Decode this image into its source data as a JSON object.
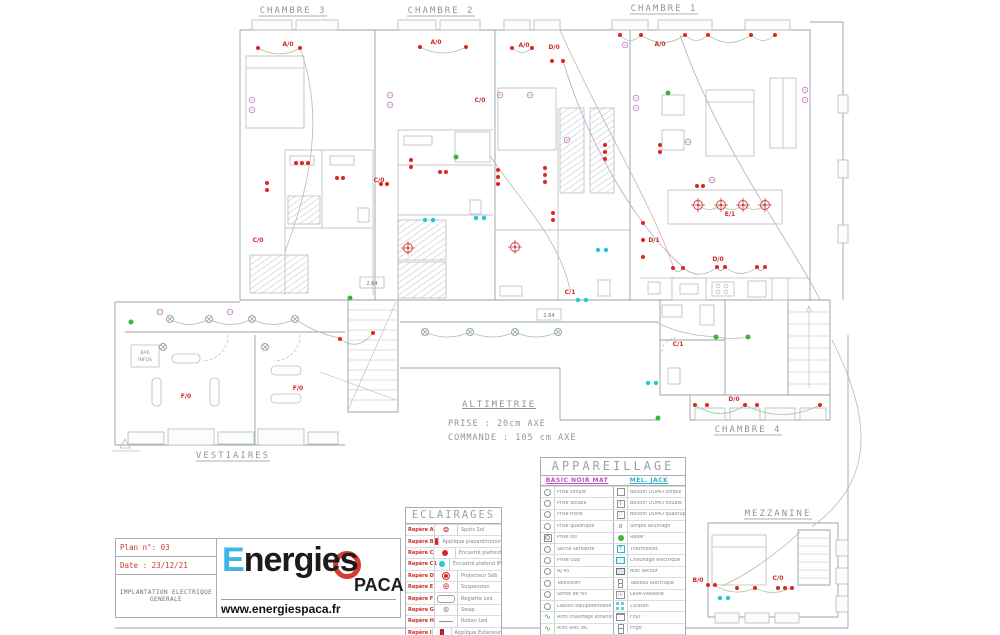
{
  "plan": {
    "room_labels": [
      "CHAMBRE 3",
      "CHAMBRE 2",
      "CHAMBRE 1",
      "VESTIAIRES",
      "CHAMBRE 4",
      "MEZZANINE"
    ],
    "circuit_labels": [
      "A/0",
      "A/0",
      "A/0",
      "D/0",
      "A/0",
      "C/0",
      "C/0",
      "C/0",
      "E/1",
      "D/1",
      "D/0",
      "C/1",
      "C/1",
      "D/0",
      "F/0",
      "F/0",
      "B/0",
      "C/0"
    ],
    "dim_labels": [
      "2.64",
      "2.64"
    ],
    "annex_box_line1": "BAR",
    "annex_box_line2": "INFOS"
  },
  "altimetrie": {
    "title": "ALTIMETRIE",
    "line1": "PRISE : 20cm AXE",
    "line2": "COMMANDE : 105 cm AXE"
  },
  "eclairages": {
    "title": "ECLAIRAGES",
    "rows": [
      {
        "repere": "Repère A",
        "icon": "spots-sol-icon",
        "desc": "Spots Sol"
      },
      {
        "repere": "Repère B",
        "icon": "applique-placard-icon",
        "desc": "Applique placard/miroir"
      },
      {
        "repere": "Repère C",
        "icon": "encastre-plafond-icon",
        "desc": "Encastré plafond"
      },
      {
        "repere": "Repère C1",
        "icon": "encastre-plafond-ip-icon",
        "desc": "Encastré plafond IP"
      },
      {
        "repere": "Repère D",
        "icon": "projecteur-icon",
        "desc": "Projecteur Sdb"
      },
      {
        "repere": "Repère E",
        "icon": "suspension-icon",
        "desc": "Suspension"
      },
      {
        "repere": "Repère F",
        "icon": "reglette-led-icon",
        "desc": "Reglette Led"
      },
      {
        "repere": "Repère G",
        "icon": "swap-icon",
        "desc": "Swap"
      },
      {
        "repere": "Repère H",
        "icon": "ruban-led-icon",
        "desc": "Ruban Led"
      },
      {
        "repere": "Repère I",
        "icon": "applique-exterieur-icon",
        "desc": "Applique Exterieur"
      },
      {
        "repere": "Repère J",
        "icon": "prise-commandee-icon",
        "desc": "Prise commandée"
      }
    ]
  },
  "appareillage": {
    "title": "APPAREILLAGE",
    "left_header": "BASIC NOIR MAT",
    "right_header": "MEL. JACK",
    "rows": [
      {
        "left": "Prise simple",
        "right": "Bouton DOMO simple"
      },
      {
        "left": "Prise double",
        "right": "Bouton DOMO double"
      },
      {
        "left": "Prise triple",
        "right": "Bouton DOMO quadruple"
      },
      {
        "left": "Prise quadruple",
        "right": "Simple allumage"
      },
      {
        "left": "Prise sol",
        "right": "Radar"
      },
      {
        "left": "Sèche serviette",
        "right": "Thermostat"
      },
      {
        "left": "Prise USB",
        "right": "Chauffage électrique"
      },
      {
        "left": "RJ 45",
        "right": "Bloc secour"
      },
      {
        "left": "Télévision",
        "right": "Tableau électrique"
      },
      {
        "left": "Sortie de fils",
        "right": "Lave-vaisselle"
      },
      {
        "left": "Liaison équipotentielle",
        "right": "Cuisson"
      },
      {
        "left": "Alim chauffage ethanol",
        "right": "Four"
      },
      {
        "left": "Alim élec WC",
        "right": "Frigo"
      },
      {
        "left": "Antenne TV",
        "right": "Tableau général"
      }
    ]
  },
  "title_block": {
    "plan_no": "Plan n°: 03",
    "date": "Date : 23/12/21",
    "subtitle_1": "IMPLANTATION ELECTRIQUE",
    "subtitle_2": "GENERALE",
    "brand_e": "E",
    "brand_rest": "nergies",
    "brand_sub": "PACA",
    "website": "www.energiespaca.fr"
  },
  "colors": {
    "accent_red": "#cf2a27",
    "cyan": "#1ec9d9",
    "magenta": "#c050c0",
    "logo_blue": "#3eb4e8",
    "logo_red": "#d63c30",
    "wall_grey": "#9aa2a7"
  }
}
